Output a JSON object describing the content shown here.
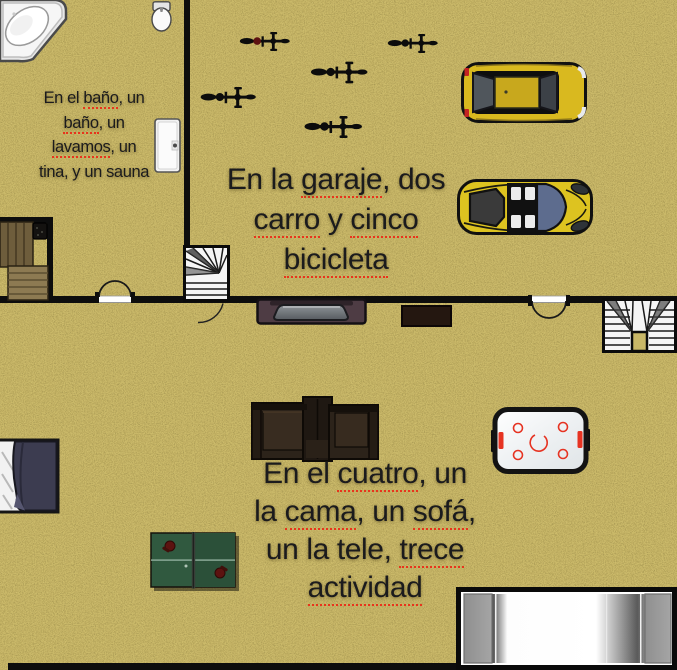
{
  "scene": {
    "type": "floor-plan",
    "rooms": [
      "bathroom",
      "garage",
      "lower-room"
    ]
  },
  "colors": {
    "floor": "#c9b868",
    "floor_speckle_dark": "#6e6330",
    "floor_speckle_light": "#ead98f",
    "wall": "#0d0d0d",
    "text": "#1b1b1d",
    "misspelling_underline": "#e8341c",
    "sedan_yellow": "#d9b91f",
    "sports_car_yellow": "#ddc320",
    "windshield_blue": "#5d6c8e",
    "pingpong_green": "#30593f",
    "paddle_red": "#5c1210",
    "air_hockey_red": "#e63322",
    "blanket_navy": "#3c3c50",
    "sofa_brown": "#2c231a",
    "tv_plum": "#4e3c44",
    "bench_wood": "#8d7a52",
    "stairs_white": "#f5f5f5"
  },
  "labels": {
    "bathroom": {
      "lines": [
        [
          {
            "t": "En el "
          },
          {
            "t": "baño",
            "m": 1
          },
          {
            "t": ", un"
          }
        ],
        [
          {
            "t": "baño",
            "m": 1
          },
          {
            "t": ", un"
          }
        ],
        [
          {
            "t": "lavamos",
            "m": 1
          },
          {
            "t": ", un"
          }
        ],
        [
          {
            "t": "tina, y un sauna"
          }
        ]
      ]
    },
    "garage": {
      "lines": [
        [
          {
            "t": "En la "
          },
          {
            "t": "garaje",
            "m": 1
          },
          {
            "t": ", dos"
          }
        ],
        [
          {
            "t": "carro",
            "m": 1
          },
          {
            "t": " y "
          },
          {
            "t": "cinco",
            "m": 1
          }
        ],
        [
          {
            "t": "bicicleta",
            "m": 1
          }
        ]
      ]
    },
    "room": {
      "lines": [
        [
          {
            "t": "En el "
          },
          {
            "t": "cuatro",
            "m": 1
          },
          {
            "t": ", un"
          }
        ],
        [
          {
            "t": "la "
          },
          {
            "t": "cama",
            "m": 1
          },
          {
            "t": ", un "
          },
          {
            "t": "sofá",
            "m": 1
          },
          {
            "t": ","
          }
        ],
        [
          {
            "t": "un la tele, "
          },
          {
            "t": "trece",
            "m": 1
          }
        ],
        [
          {
            "t": "actividad",
            "m": 1
          }
        ]
      ]
    }
  },
  "objects": {
    "bathroom": [
      "bathtub-icon",
      "toilet-icon",
      "sink-icon",
      "sauna-bench-icon",
      "sauna-heater-icon",
      "double-door-icon"
    ],
    "garage": [
      "bicycle-icon",
      "bicycle-icon",
      "bicycle-icon",
      "bicycle-icon",
      "bicycle-icon",
      "sedan-car-icon",
      "sports-car-icon",
      "spiral-stairs-icon"
    ],
    "lower_room": [
      "tv-icon",
      "cabinet-icon",
      "double-door-icon",
      "door-swing-icon",
      "u-turn-stairs-icon",
      "bed-icon",
      "sofa-icon",
      "air-hockey-table-icon",
      "ping-pong-table-icon",
      "large-bed-icon"
    ]
  },
  "counts": {
    "bicycles": 5,
    "cars": 2
  }
}
